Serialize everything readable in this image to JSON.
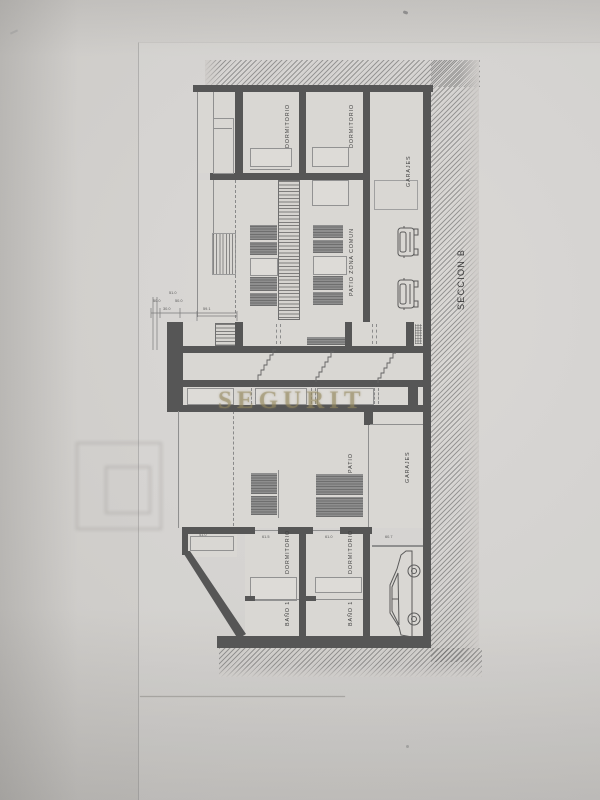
{
  "document": {
    "kind": "architectural-section-drawing-photo",
    "section_title": "SECCION B",
    "watermark": "SEGURIT"
  },
  "rooms": {
    "dormitorio_upper_1": "DORMITORIO",
    "dormitorio_upper_2": "DORMITORIO",
    "garajes_upper": "GARAJES",
    "patio_zona_comun": "PATIO ZONA COMUN",
    "patio": "PATIO",
    "garajes_lower": "GARAJES",
    "dormitorio_lower_1": "DORMITORIO",
    "dormitorio_lower_2": "DORMITORIO",
    "bano_1a": "BAÑO 1",
    "bano_1b": "BAÑO 1"
  },
  "dims": {
    "d51": "51.0",
    "d50a": "50.0",
    "d50b": "50.0",
    "d30": "30.0",
    "d591": "59.1",
    "d410": "41.0",
    "d615": "61.5",
    "d610": "61.0",
    "d607": "60.7"
  },
  "colors": {
    "wall": "#565656",
    "paper": "#cfccc9",
    "room_fill": "#d9d7d3",
    "hatch": "#585858",
    "furniture": "#8e8e8e",
    "watermark": "#968a5f",
    "label_text": "#3f3f3f"
  }
}
